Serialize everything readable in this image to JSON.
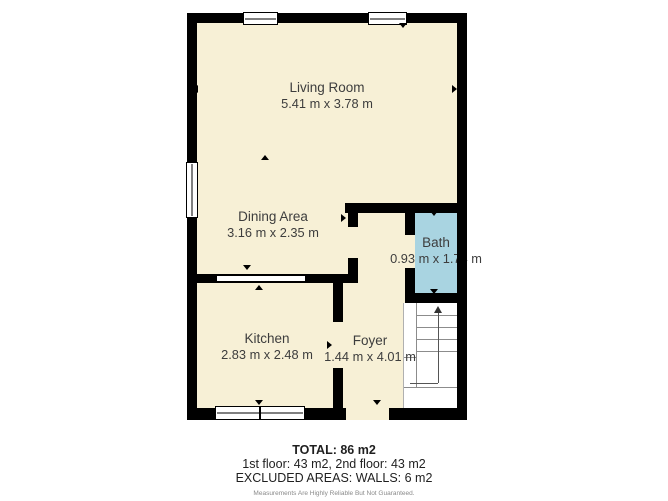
{
  "plan": {
    "rooms": [
      {
        "name": "Living Room",
        "dimensions": "5.41 m x 3.78 m"
      },
      {
        "name": "Dining Area",
        "dimensions": "3.16 m x 2.35 m"
      },
      {
        "name": "Bath",
        "dimensions": "0.93 m x 1.74 m"
      },
      {
        "name": "Kitchen",
        "dimensions": "2.83 m x 2.48 m"
      },
      {
        "name": "Foyer",
        "dimensions": "1.44 m x 4.01 m"
      }
    ],
    "icons": {
      "stairs": "staircase-with-up-arrow",
      "markers": "small-black-triangle-opening-markers",
      "windows": "double-line-window-symbols"
    },
    "colors": {
      "floor": "#f7f0d6",
      "bath_floor": "#a9d4e1",
      "wall": "#000000",
      "stair_lines": "#8c8c8c"
    }
  },
  "footer": {
    "total": "TOTAL: 86 m2",
    "floors": "1st floor: 43 m2, 2nd floor: 43 m2",
    "excluded": "EXCLUDED AREAS: WALLS: 6 m2",
    "disclaimer": "Measurements Are Highly Reliable But Not Guaranteed."
  }
}
